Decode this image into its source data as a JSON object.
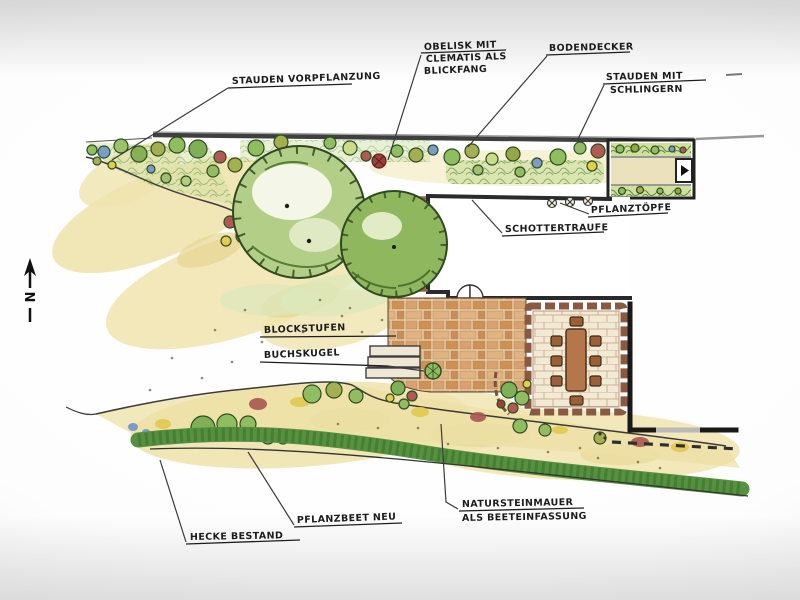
{
  "compass": {
    "north_label": "N"
  },
  "labels": {
    "stauden_vorpflanzung": "STAUDEN VORPFLANZUNG",
    "obelisk": {
      "line1": "OBELISK MIT",
      "line2": "CLEMATIS ALS",
      "line3": "BLICKFANG"
    },
    "bodendecker": "BODENDECKER",
    "stauden_schlinger": {
      "line1": "STAUDEN MIT",
      "line2": "SCHLINGERN"
    },
    "pflanztoepfe": "PFLANZTÖPFE",
    "schottertraufe": "SCHOTTERTRAUFE",
    "blockstufen": "BLOCKSTUFEN",
    "buchskugel": "BUCHSKUGEL",
    "natursteinmauer": {
      "line1": "NATURSTEINMAUER",
      "line2": "ALS BEETEINFASSUNG"
    },
    "pflanzbeet_neu": "PFLANZBEET NEU",
    "hecke_bestand": "HECKE BESTAND"
  },
  "colors": {
    "page_edge": "#d6d6d6",
    "paper": "#ffffff",
    "ink": "#2a2a2a",
    "lawn_wash": "#f0e4ae",
    "tree_green": "#b3cf87",
    "tree_green_dark": "#8fb75e",
    "hedge_green": "#569140",
    "paving_terracotta": "#d8a270",
    "terrace_paving": "#f3ead6",
    "stone_border": "#8a5a40",
    "table_brown": "#b5764a",
    "accent_red": "#b15a54",
    "accent_yellow": "#e3cd4f",
    "accent_blue": "#7b9cc7"
  }
}
